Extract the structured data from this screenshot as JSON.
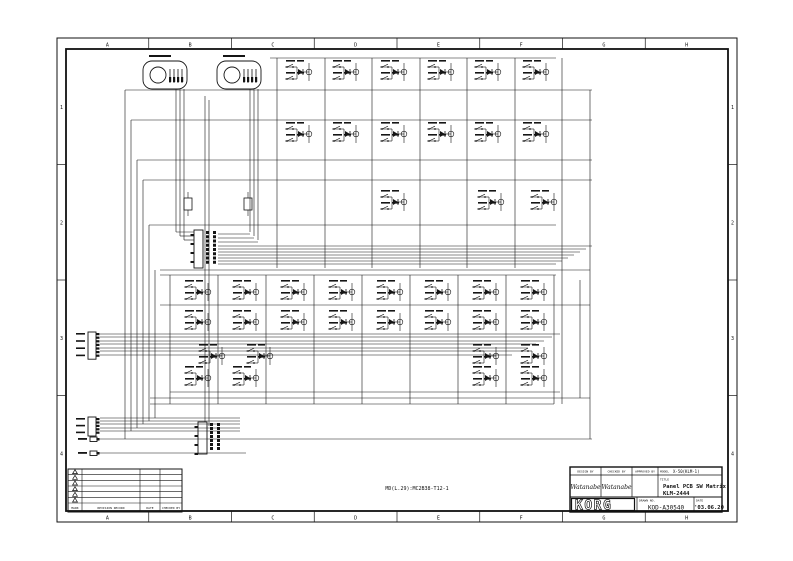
{
  "sheet": {
    "ink": "#151515",
    "background": "#ffffff"
  },
  "frame": {
    "columns": [
      "A",
      "B",
      "C",
      "D",
      "E",
      "F",
      "G",
      "H"
    ],
    "rows": [
      "1",
      "2",
      "3",
      "4"
    ]
  },
  "footer_note": "MD(L.29):MC2B38-T12-1",
  "revision_table": {
    "mark_symbol": "revision-triangle",
    "row_count": 6,
    "headers": [
      "MARK",
      "REVISION RECORD",
      "DATE",
      "CHECKED BY"
    ]
  },
  "title_block": {
    "headers": [
      "DESIGN BY",
      "CHECKED BY",
      "APPROVED BY"
    ],
    "model_label": "MODEL",
    "model": "X-50(KLM-1)",
    "signatures": [
      "Watanabe",
      "Watanabe"
    ],
    "title_label": "TITLE",
    "title_line1": "Panel PCB SW Matrix",
    "title_line2": "KLM-2444",
    "brand": "KORG",
    "drawing_no_label": "DRAWN NO.",
    "drawing_no": "KOD-A30540",
    "date_label": "DATE",
    "date": "'03.06.20"
  },
  "schematic": {
    "cell_size": [
      34,
      24
    ],
    "jacks": [
      {
        "x": 143,
        "y": 61
      },
      {
        "x": 217,
        "y": 61
      }
    ],
    "upper_rows": [
      {
        "y": 60,
        "xs": [
          283,
          330,
          378,
          425,
          472,
          520
        ]
      },
      {
        "y": 122,
        "xs": [
          283,
          330,
          378,
          425,
          472,
          520
        ]
      },
      {
        "y": 190,
        "xs": [
          378,
          475,
          528
        ]
      }
    ],
    "lower_rows": [
      {
        "y": 280,
        "xs": [
          182,
          230,
          278,
          326,
          374,
          422,
          470,
          518
        ]
      },
      {
        "y": 310,
        "xs": [
          182,
          230,
          278,
          326,
          374,
          422,
          470,
          518
        ]
      },
      {
        "y": 344,
        "xs": [
          196,
          244,
          470,
          518
        ]
      },
      {
        "y": 366,
        "xs": [
          182,
          230,
          470,
          518
        ]
      }
    ],
    "connectors": [
      {
        "x": 88,
        "y": 332,
        "pins": 7,
        "pitch": 3.6
      },
      {
        "x": 88,
        "y": 417,
        "pins": 5,
        "pitch": 3.4
      }
    ],
    "singles": [
      {
        "x": 90,
        "y": 437
      },
      {
        "x": 90,
        "y": 451
      }
    ],
    "ics": [
      {
        "x": 194,
        "y": 230,
        "h": 38,
        "pads": 8
      },
      {
        "x": 198,
        "y": 422,
        "h": 32,
        "pads": 7
      }
    ],
    "resistors": [
      {
        "x": 184,
        "y": 198
      },
      {
        "x": 244,
        "y": 198
      }
    ],
    "wires": [
      [
        125,
        90,
        592,
        90
      ],
      [
        131,
        120,
        592,
        120
      ],
      [
        137,
        160,
        592,
        160
      ],
      [
        143,
        180,
        592,
        180
      ],
      [
        149,
        225,
        556,
        225
      ],
      [
        270,
        58,
        556,
        58
      ],
      [
        218,
        246,
        592,
        246
      ],
      [
        218,
        249,
        586,
        249
      ],
      [
        218,
        252,
        580,
        252
      ],
      [
        218,
        255,
        574,
        255
      ],
      [
        218,
        258,
        568,
        258
      ],
      [
        218,
        261,
        562,
        261
      ],
      [
        218,
        264,
        556,
        264
      ],
      [
        100,
        334,
        560,
        334
      ],
      [
        100,
        337,
        552,
        337
      ],
      [
        100,
        341,
        544,
        341
      ],
      [
        100,
        344,
        536,
        344
      ],
      [
        100,
        348,
        528,
        348
      ],
      [
        100,
        351,
        520,
        351
      ],
      [
        100,
        355,
        512,
        355
      ],
      [
        160,
        270,
        590,
        270
      ],
      [
        160,
        275,
        556,
        275
      ],
      [
        160,
        305,
        590,
        305
      ],
      [
        170,
        392,
        560,
        392
      ],
      [
        150,
        398,
        590,
        398
      ],
      [
        150,
        404,
        554,
        404
      ],
      [
        100,
        418,
        240,
        418
      ],
      [
        100,
        421,
        240,
        421
      ],
      [
        100,
        424,
        240,
        424
      ],
      [
        100,
        428,
        240,
        428
      ],
      [
        100,
        431,
        240,
        431
      ],
      [
        96,
        439,
        592,
        439
      ],
      [
        96,
        453,
        246,
        453
      ],
      [
        125,
        90,
        125,
        439
      ],
      [
        131,
        120,
        131,
        431
      ],
      [
        137,
        160,
        137,
        428
      ],
      [
        143,
        180,
        143,
        424
      ],
      [
        149,
        225,
        149,
        421
      ],
      [
        155,
        270,
        155,
        418
      ],
      [
        176,
        89,
        176,
        232
      ],
      [
        180,
        89,
        180,
        236
      ],
      [
        184,
        89,
        184,
        240
      ],
      [
        250,
        89,
        250,
        232
      ],
      [
        254,
        89,
        254,
        236
      ],
      [
        258,
        89,
        258,
        240
      ],
      [
        176,
        232,
        194,
        232
      ],
      [
        180,
        236,
        194,
        236
      ],
      [
        184,
        240,
        194,
        240
      ],
      [
        250,
        234,
        218,
        234
      ],
      [
        254,
        238,
        218,
        238
      ],
      [
        258,
        242,
        218,
        242
      ],
      [
        205,
        96,
        205,
        422
      ],
      [
        209,
        100,
        209,
        426
      ],
      [
        277,
        58,
        277,
        268
      ],
      [
        325,
        58,
        325,
        268
      ],
      [
        372,
        58,
        372,
        268
      ],
      [
        420,
        58,
        420,
        268
      ],
      [
        467,
        58,
        467,
        268
      ],
      [
        515,
        58,
        515,
        268
      ],
      [
        562,
        58,
        562,
        404
      ],
      [
        590,
        90,
        590,
        439
      ],
      [
        170,
        275,
        170,
        404
      ],
      [
        218,
        275,
        218,
        404
      ],
      [
        266,
        275,
        266,
        404
      ],
      [
        314,
        275,
        314,
        404
      ],
      [
        362,
        275,
        362,
        404
      ],
      [
        410,
        275,
        410,
        404
      ],
      [
        458,
        275,
        458,
        404
      ],
      [
        506,
        275,
        506,
        404
      ],
      [
        554,
        275,
        554,
        404
      ],
      [
        580,
        280,
        580,
        398
      ]
    ]
  }
}
